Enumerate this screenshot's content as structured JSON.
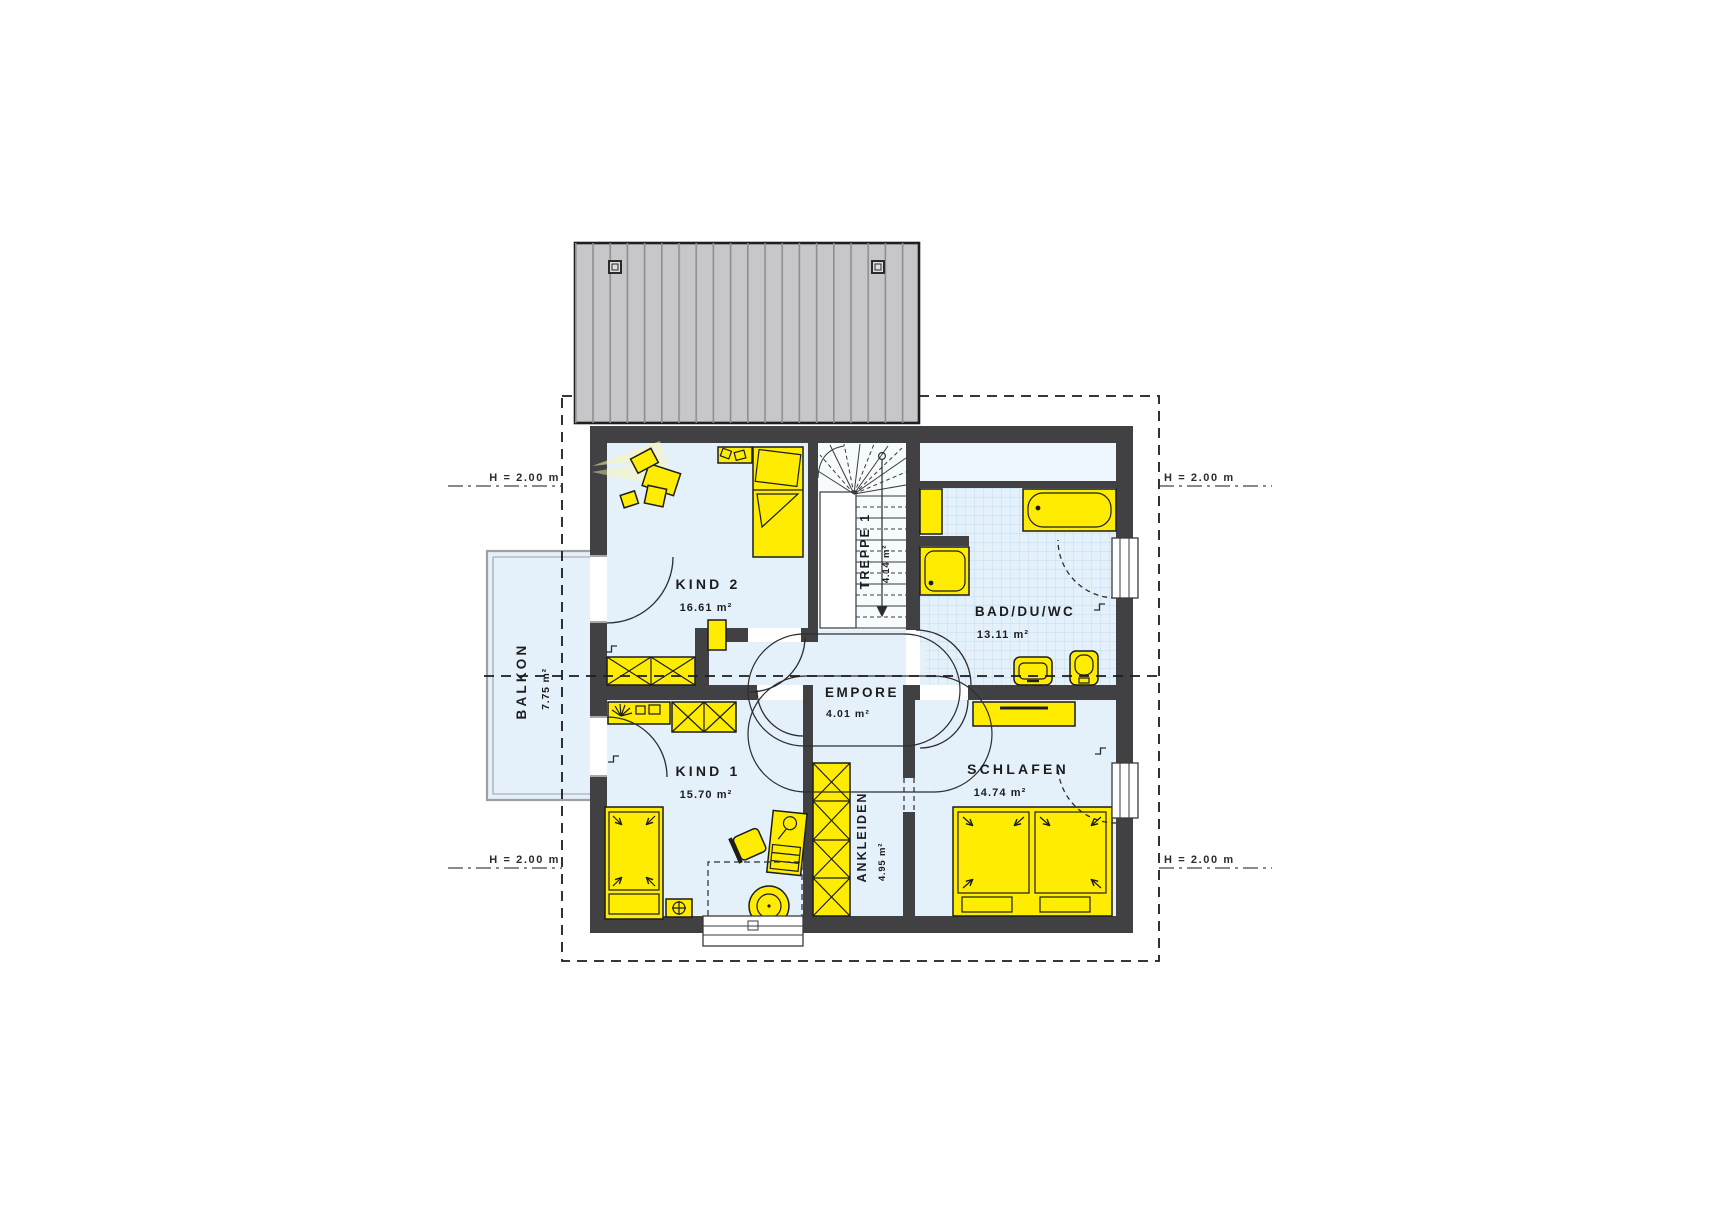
{
  "plan": {
    "rooms": {
      "kind2": {
        "name": "KIND 2",
        "area": "16.61 m²"
      },
      "kind1": {
        "name": "KIND 1",
        "area": "15.70 m²"
      },
      "bad": {
        "name": "BAD/DU/WC",
        "area": "13.11 m²"
      },
      "schlafen": {
        "name": "SCHLAFEN",
        "area": "14.74 m²"
      },
      "empore": {
        "name": "EMPORE",
        "area": "4.01 m²"
      },
      "treppe": {
        "name": "TREPPE 1",
        "area": "4.14 m²"
      },
      "ankleiden": {
        "name": "ANKLEIDEN",
        "area": "4.95 m²"
      },
      "balkon": {
        "name": "BALKON",
        "area": "7.75 m²"
      }
    },
    "annotations": {
      "height_line": "H = 2.00 m"
    },
    "colors": {
      "furniture_yellow": "#ffec00",
      "wall_dark": "#414144",
      "floor_blue": "#e4f1fb",
      "roof_gray": "#c7c7c9",
      "tile_line": "#bfdcf0"
    }
  }
}
